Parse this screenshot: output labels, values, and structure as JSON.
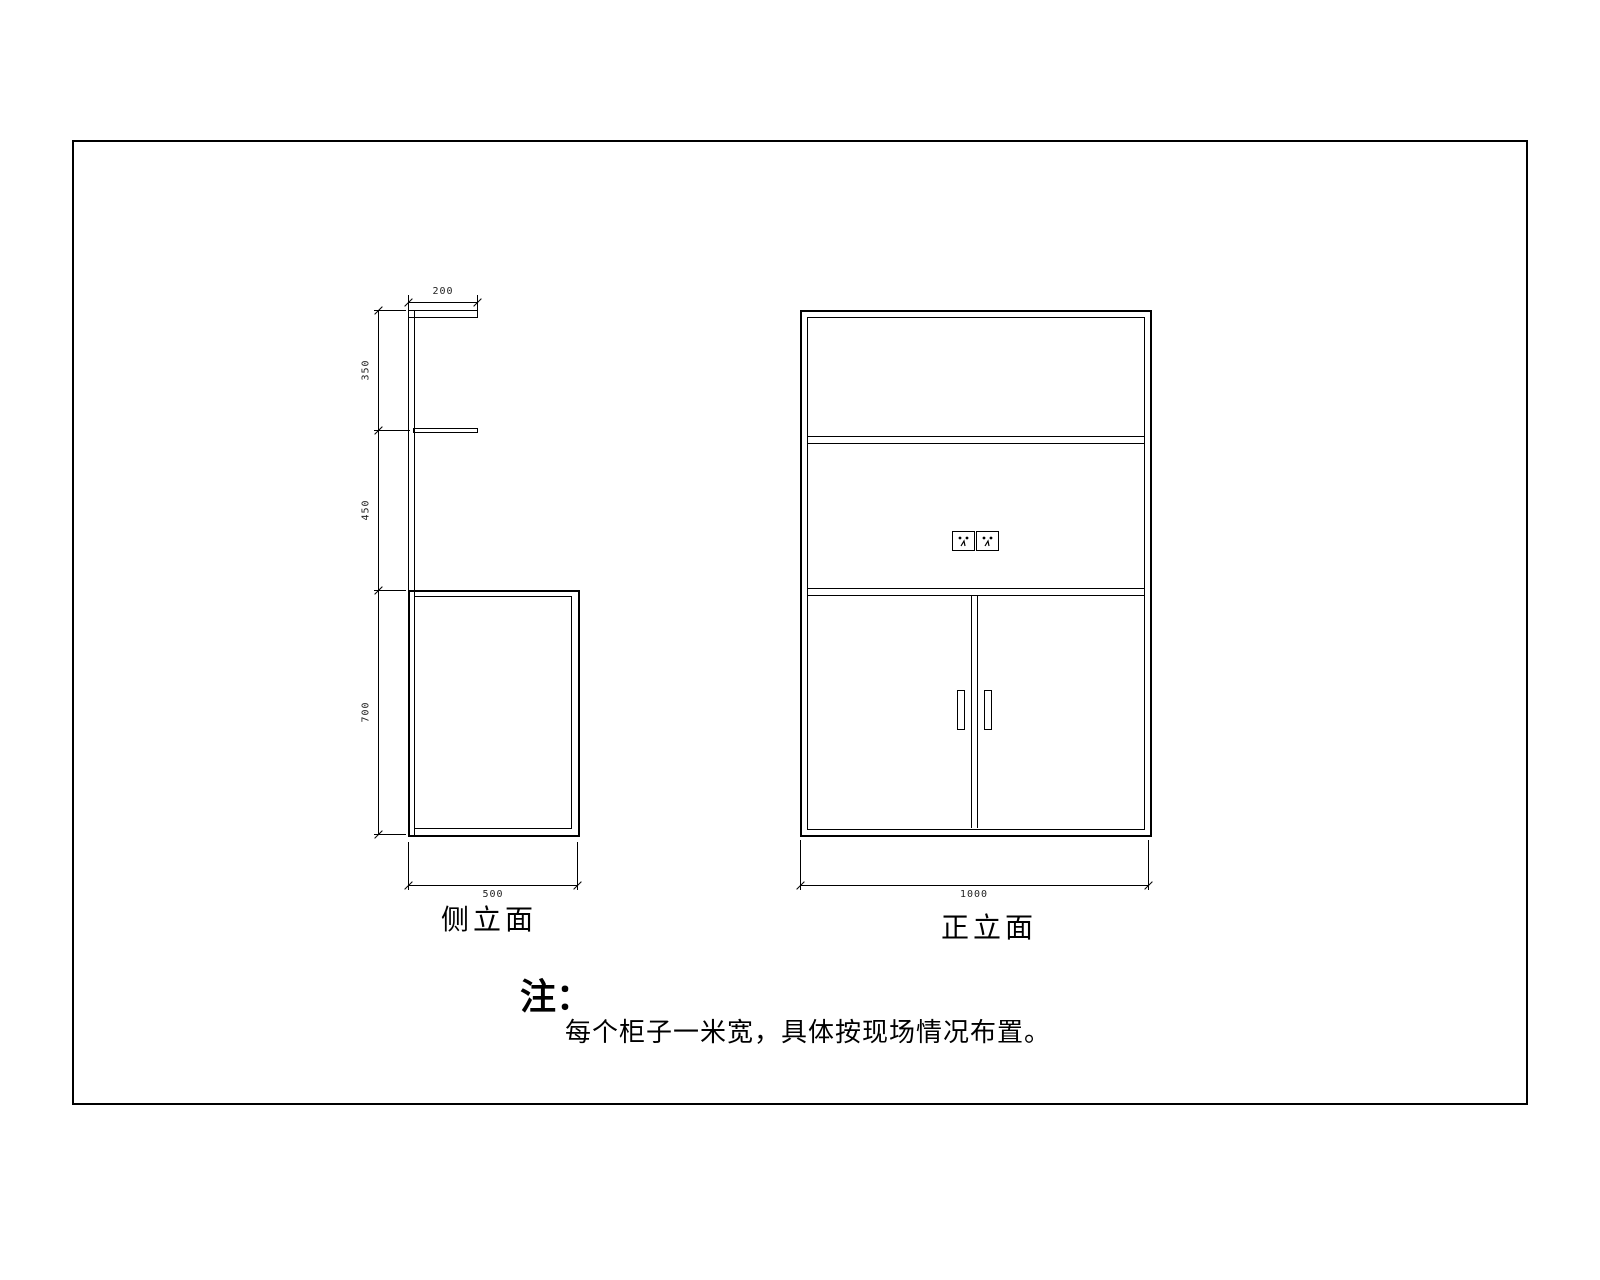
{
  "sheet": {
    "background": "#ffffff",
    "line_color": "#000000"
  },
  "side_view": {
    "label": "侧立面",
    "dims": {
      "top_width": "200",
      "bottom_width": "500",
      "heights": [
        {
          "value": "350"
        },
        {
          "value": "450"
        },
        {
          "value": "700"
        }
      ]
    }
  },
  "front_view": {
    "label": "正立面",
    "dims": {
      "bottom_width": "1000"
    },
    "icons": {
      "left_socket": "socket-outlet",
      "right_socket": "socket-outlet"
    }
  },
  "note": {
    "heading": "注：",
    "body": "每个柜子一米宽，具体按现场情况布置。"
  }
}
